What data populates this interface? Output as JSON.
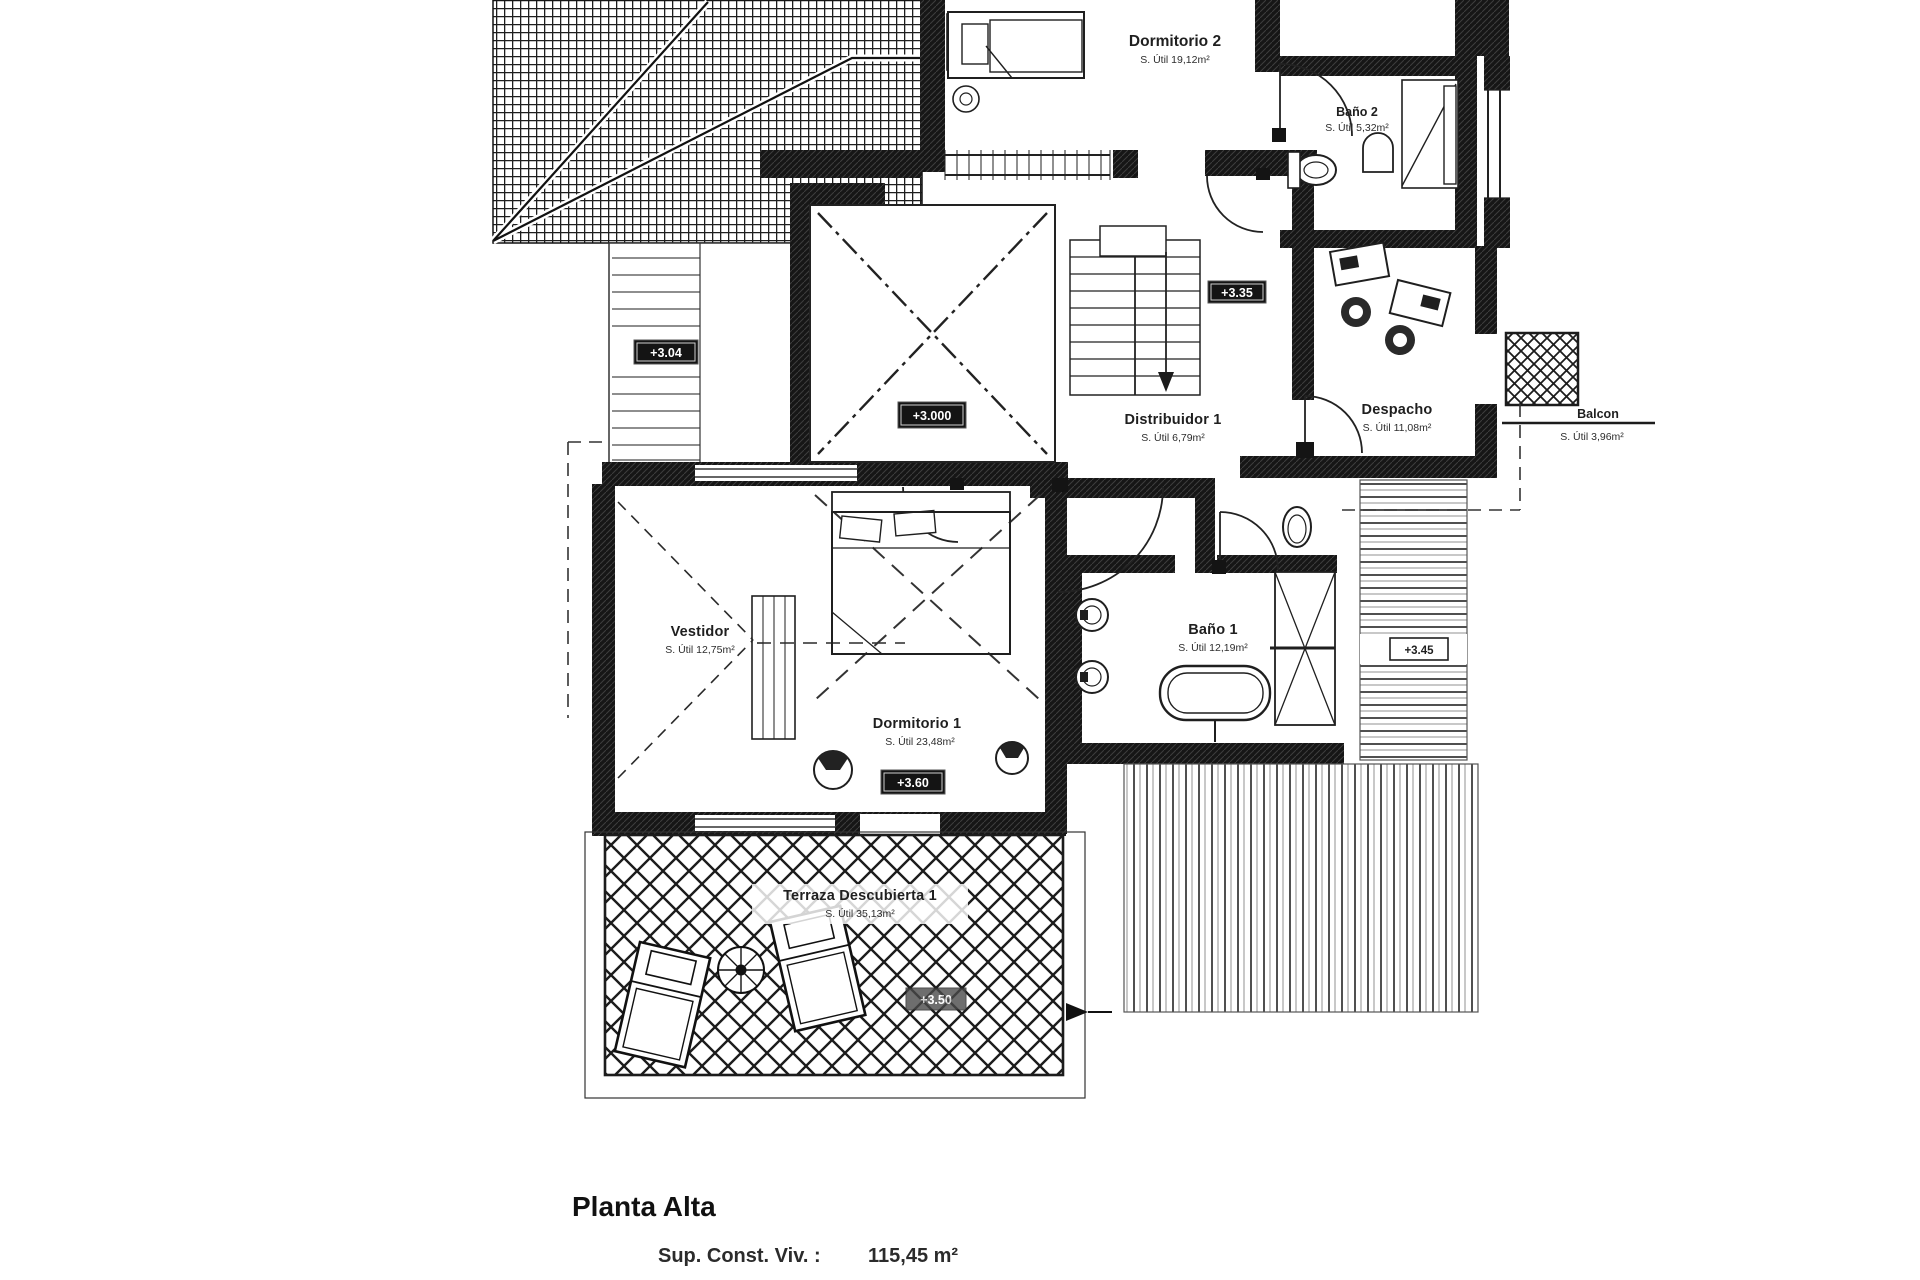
{
  "floor_plan": {
    "rooms": [
      {
        "name": "Dormitorio 2",
        "area": "S. Útil 19,12m²"
      },
      {
        "name": "Baño 2",
        "area": "S. Útil 5,32m²"
      },
      {
        "name": "Despacho",
        "area": "S. Útil 11,08m²"
      },
      {
        "name": "Distribuidor 1",
        "area": "S. Útil 6,79m²"
      },
      {
        "name": "Vestidor",
        "area": "S. Útil 12,75m²"
      },
      {
        "name": "Dormitorio 1",
        "area": "S. Útil 23,48m²"
      },
      {
        "name": "Baño 1",
        "area": "S. Útil 12,19m²"
      },
      {
        "name": "Terraza Descubierta 1",
        "area": "S. Útil 35,13m²"
      },
      {
        "name": "Balcon",
        "area": "S. Útil 3,96m²"
      }
    ],
    "level_markers": [
      {
        "text": "+3.04"
      },
      {
        "text": "+3.000"
      },
      {
        "text": "+3.35"
      },
      {
        "text": "+3.60"
      },
      {
        "text": "+3.45"
      },
      {
        "text": "+3.50"
      }
    ],
    "title_block": {
      "title": "Planta Alta",
      "area_label": "Sup. Const. Viv. :",
      "area_value": "115,45 m²"
    },
    "ink_color": "#1c1c1c"
  }
}
